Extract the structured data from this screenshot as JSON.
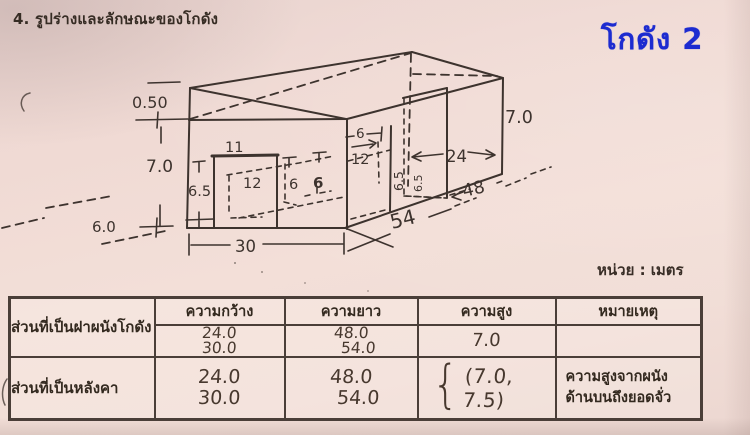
{
  "page": {
    "title": "4. รูปร่างและลักษณะของโกดัง",
    "warehouse_badge": "โกดัง 2",
    "unit_note": "หน่วย : เมตร",
    "accent_blue": "#1c2bd0",
    "ink_color": "#3d332e",
    "paper_color": "#f0dad4"
  },
  "diagram": {
    "dims": {
      "roof_rise": "0.50",
      "wall_height_left": "7.0",
      "ground_offset": "6.0",
      "front_door_width": "11",
      "front_door_height": "6.5",
      "front_door_inner_width": "12",
      "back_opening_height_a": "6",
      "back_opening_height_b": "6",
      "mid_opening_width": "6",
      "mid_opening_inner_width": "12",
      "mid_opening_height": "6.5",
      "right_opening_height": "6.5",
      "right_door_width": "24",
      "wall_height_right": "7.0",
      "roof_length": "48",
      "wall_length": "54",
      "front_width": "30"
    }
  },
  "table": {
    "headers": {
      "width": "ความกว้าง",
      "length": "ความยาว",
      "height": "ความสูง",
      "remark": "หมายเหตุ"
    },
    "rows": [
      {
        "label": "ส่วนที่เป็นฝาผนังโกดัง",
        "width_values": [
          "24.0",
          "30.0"
        ],
        "length_values": [
          "48.0",
          "54.0"
        ],
        "height_value": "7.0",
        "remark": ""
      },
      {
        "label": "ส่วนที่เป็นหลังคา",
        "width_values": [
          "24.0",
          "30.0"
        ],
        "length_values": [
          "48.0",
          "54.0"
        ],
        "height_brace": "{",
        "height_value": "(7.0, 7.5)",
        "remark_lines": [
          "ความสูงจากผนัง",
          "ด้านบนถึงยอดจั่ว"
        ]
      }
    ]
  }
}
